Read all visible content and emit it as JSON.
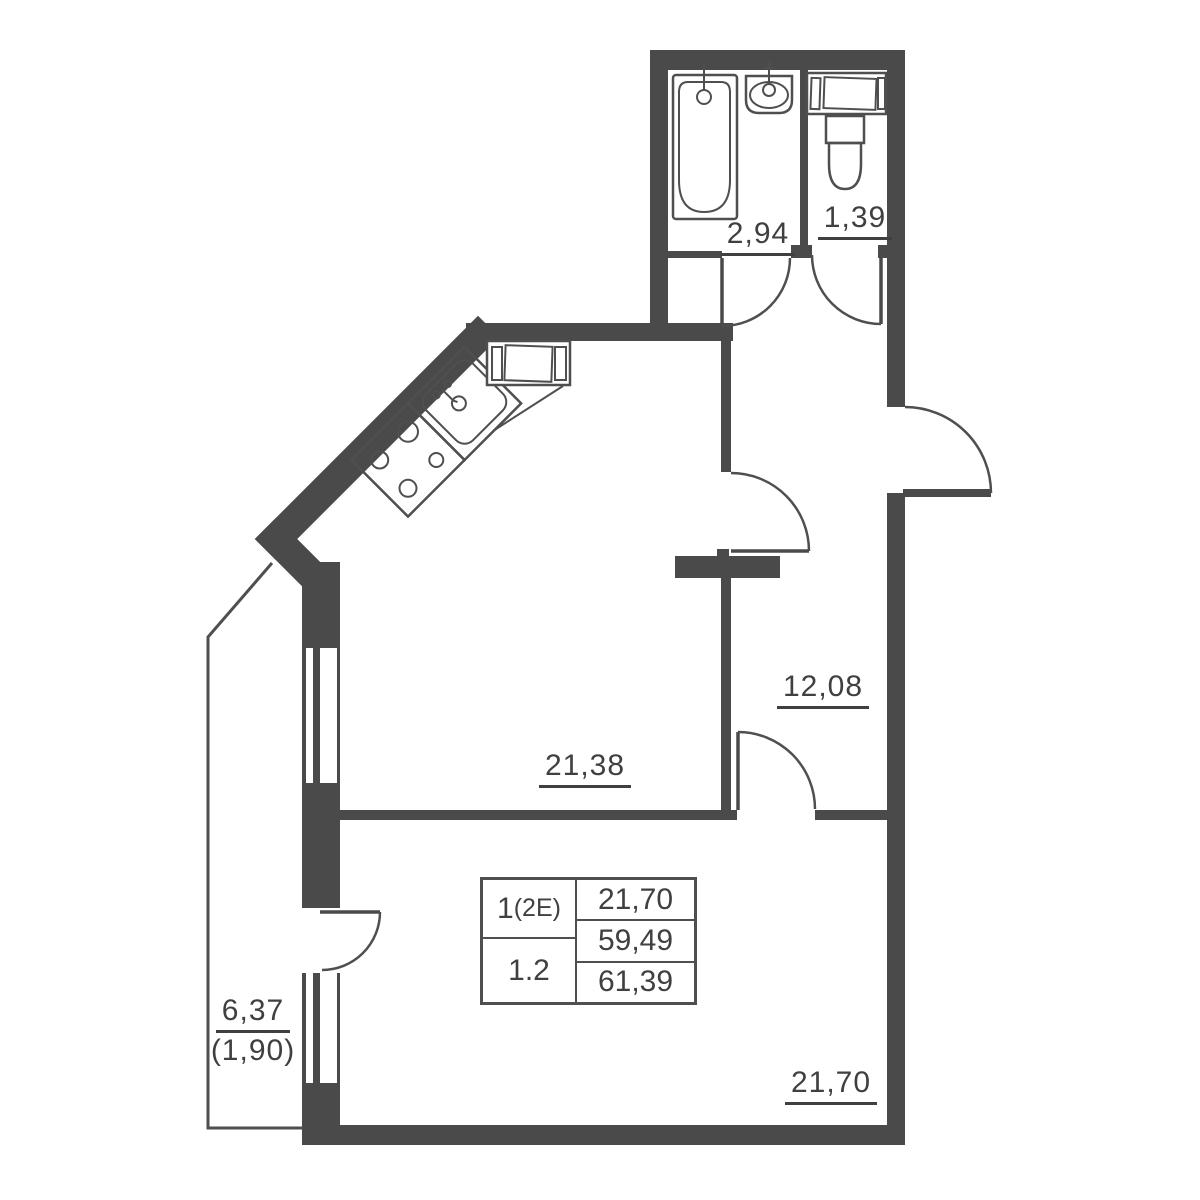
{
  "labels": {
    "bathroom_area": "2,94",
    "toilet_area": "1,39",
    "hallway_area": "12,08",
    "kitchen_living_area": "21,38",
    "living_room_area": "21,70",
    "balcony_area": "6,37",
    "balcony_area_reduced": "(1,90)"
  },
  "info_table": {
    "rooms_count": "1",
    "layout_type": "(2E)",
    "unit_number": "1.2",
    "living_area": "21,70",
    "area_excluding_balcony": "59,49",
    "total_area": "61,39"
  },
  "fixtures": [
    "bathtub-icon",
    "washbasin-icon",
    "toilet-icon",
    "washing-machine-icon",
    "kitchen-sink-icon",
    "stove-icon",
    "kitchen-appliance-icon"
  ],
  "colors": {
    "walls": "#4a4a4a",
    "lines": "#4f4f4f",
    "text": "#404040",
    "background": "#ffffff"
  }
}
